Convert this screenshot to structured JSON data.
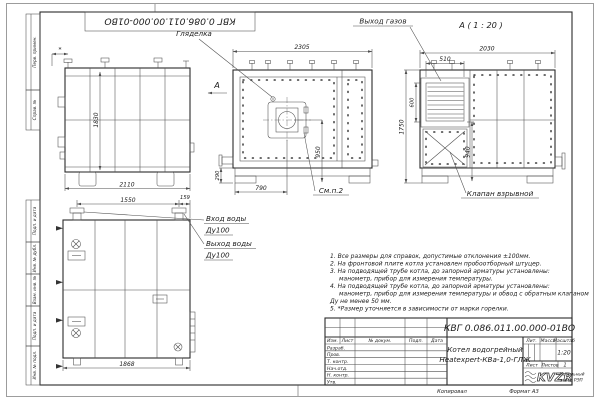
{
  "colors": {
    "line": "#2b2b2b",
    "paper": "#ffffff"
  },
  "doc": {
    "number": "КВГ 0.086.011.00.000-01ВО"
  },
  "margin": {
    "s1": "Перв. примен.",
    "s2": "Справ. №",
    "s3": "Подп. и дата",
    "s4": "Инв. № дубл.",
    "s5": "Взам. инв. №",
    "s6": "Подп. и дата",
    "s7": "Инв. № подл."
  },
  "labels": {
    "sight": "Гляделка",
    "gas_out": "Выход газов",
    "section_title": "А ( 1 : 20 )",
    "section_arrow": "А",
    "valve": "Клапан взрывной",
    "see_note": "См.п.2",
    "water_in1": "Вход воды",
    "water_in2": "Ду100",
    "water_out1": "Выход воды",
    "water_out2": "Ду100",
    "star": "*"
  },
  "dims": {
    "front_width": "2305",
    "section_width": "2030",
    "grille_w": "510",
    "grille_h": "600",
    "side_h": "1830",
    "side_w": "2110",
    "front_burner_x": "790",
    "front_burner_y": "950",
    "front_base": "290",
    "section_h": "1750",
    "valve_h": "940",
    "bottom_w1": "1550",
    "bottom_w2": "159",
    "bottom_total": "1868"
  },
  "notes": [
    "1. Все размеры для справок, допустимые отклонения ±100мм.",
    "2. На фронтовой плите котла установлен пробоотборный штуцер.",
    "3. На подводящей трубе котла, до запорной арматуры установлены:",
    "манометр, прибор для измерения температуры.",
    "4. На подводящей трубе котла, до запорной арматуры установлены:",
    "манометр, прибор для измерения температуры и обвод с обратным клапаном",
    "Ду не менее 50 мм.",
    "5. *Размер уточняется в зависимости от марки горелки."
  ],
  "title_block": {
    "name1": "Котел водогрейный",
    "name2": "Heatexpert-КВа-1,0-ГЛЖ",
    "col_izm": "Изм.",
    "col_list": "Лист",
    "col_doc": "№ докум.",
    "col_podp": "Подп.",
    "col_data": "Дата",
    "r1": "Разраб.",
    "r2": "Пров.",
    "r3": "Т. контр.",
    "r4": "Нач.отд.",
    "r5": "Н. контр.",
    "r6": "Утв.",
    "lit": "Лит.",
    "mass": "Масса",
    "scale_lbl": "Масштаб",
    "scale": "1:20",
    "sheet": "Лист",
    "sheets": "Листов",
    "sheets_n": "1",
    "logo": "KVZR",
    "logo_s1": "Котельный",
    "logo_s2": "завод РЭП",
    "copied": "Копировал",
    "format": "Формат А3"
  }
}
